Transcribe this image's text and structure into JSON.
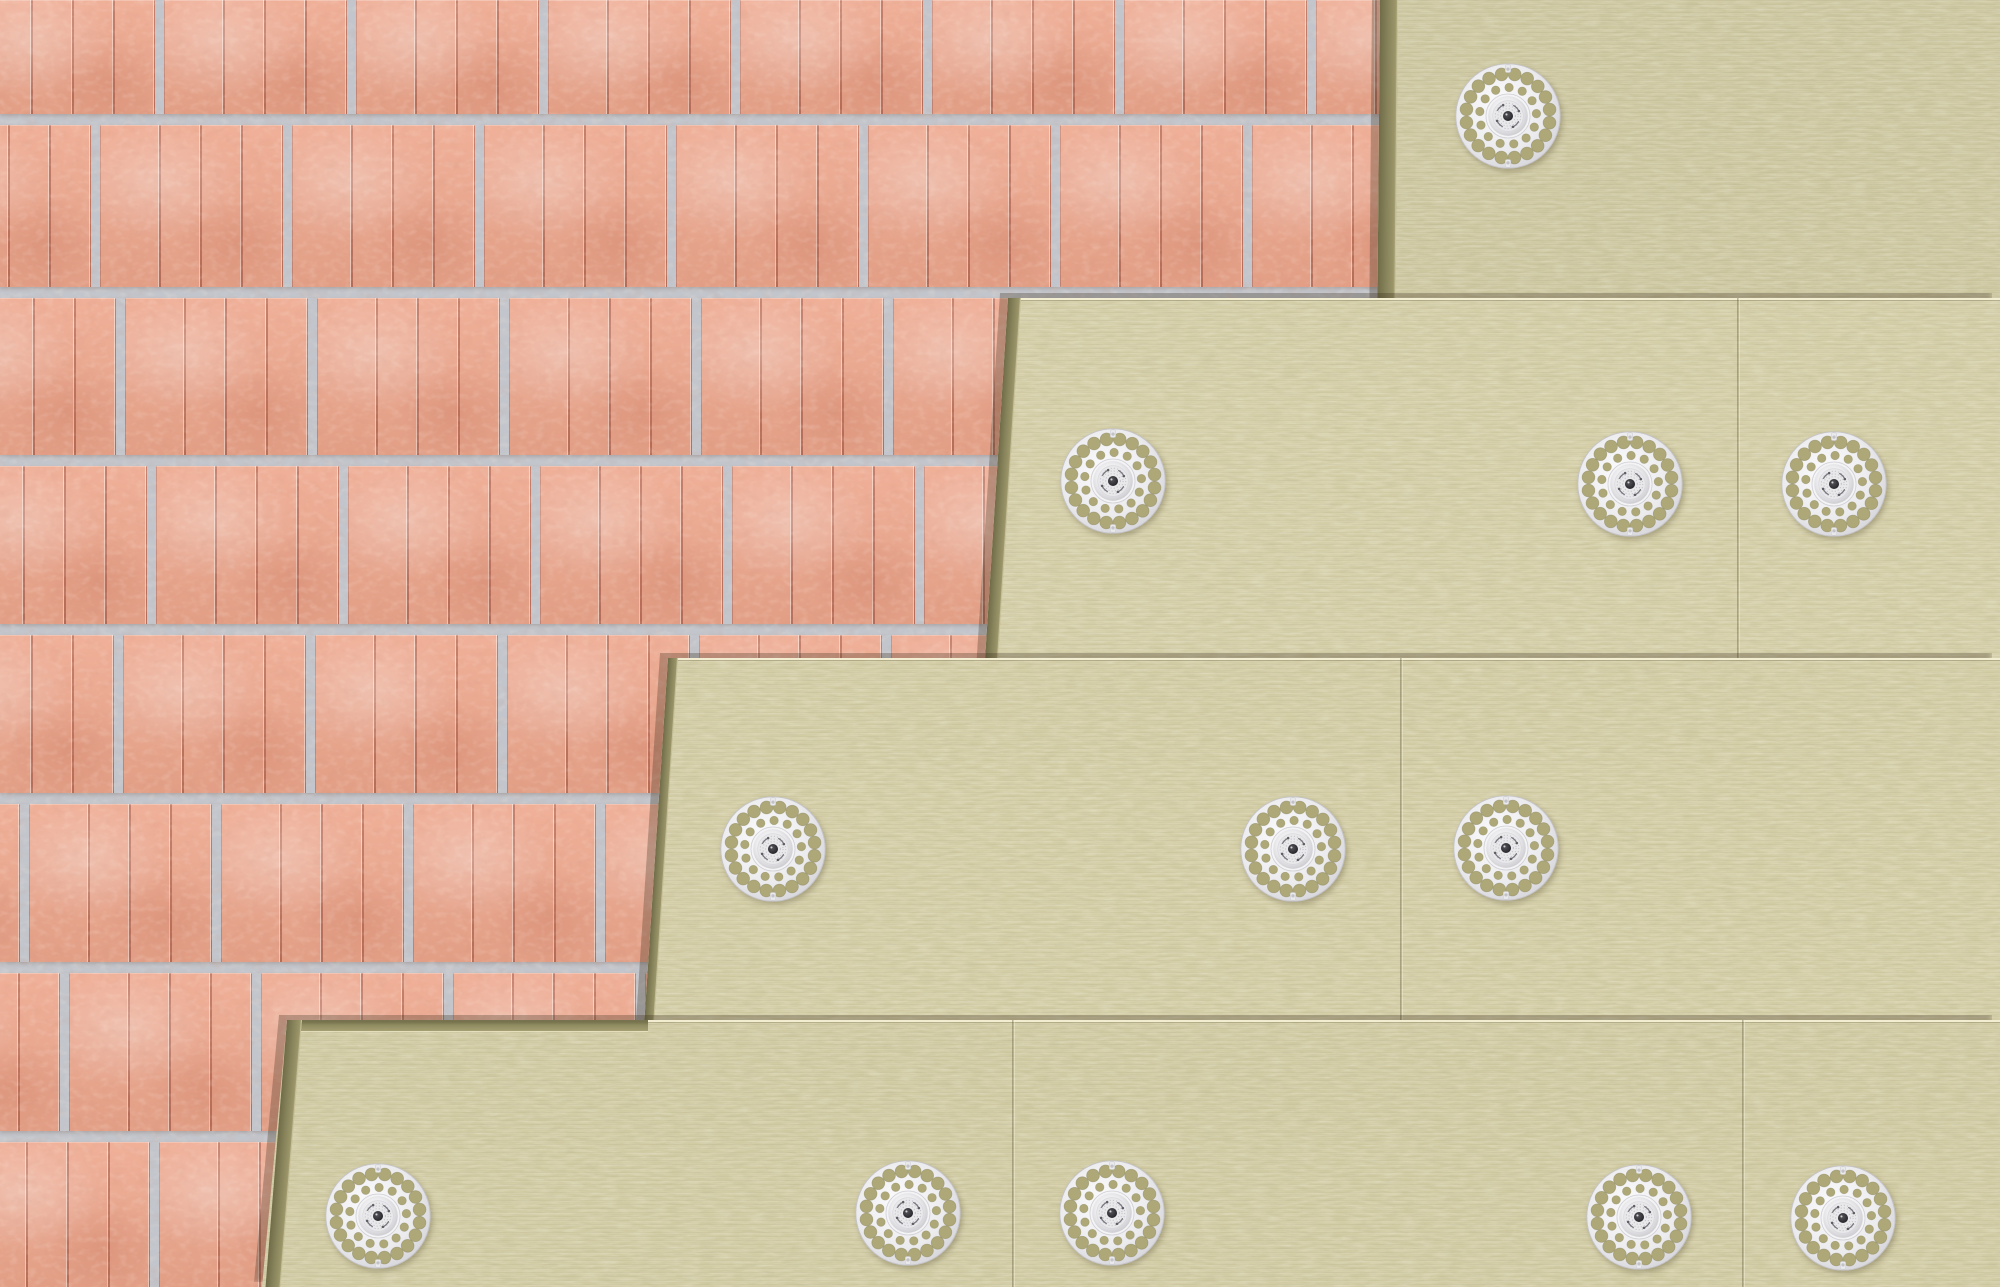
{
  "scene": {
    "description": "3D cutaway illustration of four staggered layers of mineral wool insulation boards fixed to a perforated clay block masonry wall with round perforated plastic insulation anchors",
    "canvas": {
      "width": 2000,
      "height": 1287
    },
    "layer_count": 4,
    "anchor_count": 12
  },
  "colors": {
    "mortar": "#c2c5cb",
    "brick_face": "#eea78d",
    "brick_groove": "#964734",
    "insulation_face_layer1": "#cdc7a0",
    "insulation_face_layer2": "#d4cea7",
    "insulation_face_layer3": "#d3cda5",
    "insulation_face_layer4": "#d1cba3",
    "insulation_cut_edge": "#8f8b60",
    "anchor_plastic": "#f0f0f3",
    "anchor_hole": "#aea878",
    "anchor_screw": "#2e2e31"
  },
  "brick": {
    "mortar_ys": [
      114,
      287,
      455,
      624,
      793,
      962,
      1131
    ],
    "mortar_h": 11,
    "block_pitch": 192,
    "block_w": 183,
    "joint_w": 9,
    "row_offsets": [
      155,
      91,
      116,
      147,
      114,
      20,
      60,
      150
    ]
  },
  "layers": [
    {
      "id": "insulation-layer-1",
      "face": "#cdc7a0",
      "clip": "polygon(1380px 0px, 2000px 0px, 2000px 1287px, 1369px 1287px)",
      "edge_left": {
        "x": 1380,
        "y": 0,
        "w": 18,
        "h": 1287,
        "skew": -0.49
      },
      "edge_top": null,
      "top_line": null,
      "seams": []
    },
    {
      "id": "insulation-layer-2",
      "face": "#d4cea7",
      "clip": "polygon(1008px 298px, 2000px 298px, 2000px 1287px, 945px 1287px)",
      "edge_left": {
        "x": 1008,
        "y": 298,
        "w": 13,
        "h": 989,
        "skew": -3.65
      },
      "edge_top": null,
      "top_line": {
        "x": 1008,
        "y": 298,
        "w": 992
      },
      "seams": [
        {
          "x": 1737,
          "y": 298,
          "h": 989
        }
      ]
    },
    {
      "id": "insulation-layer-3",
      "face": "#d3cda5",
      "clip": "polygon(668px 658px, 2000px 658px, 2000px 1287px, 627px 1287px)",
      "edge_left": {
        "x": 668,
        "y": 658,
        "w": 10,
        "h": 629,
        "skew": -3.73
      },
      "edge_top": null,
      "top_line": {
        "x": 668,
        "y": 658,
        "w": 1332
      },
      "seams": [
        {
          "x": 1400,
          "y": 658,
          "h": 629
        }
      ]
    },
    {
      "id": "insulation-layer-4",
      "face": "#d1cba3",
      "clip": "polygon(287px 1020px, 2000px 1020px, 2000px 1287px, 262px 1287px)",
      "edge_left": {
        "x": 287,
        "y": 1020,
        "w": 15,
        "h": 267,
        "skew": -4.6
      },
      "edge_top": {
        "x": 287,
        "y": 1020,
        "w": 361,
        "h": 11
      },
      "top_line": {
        "x": 648,
        "y": 1020,
        "w": 1352
      },
      "seams": [
        {
          "x": 1012,
          "y": 1020,
          "h": 267
        },
        {
          "x": 1742,
          "y": 1020,
          "h": 267
        }
      ]
    }
  ],
  "anchors": [
    {
      "x": 1508,
      "y": 116
    },
    {
      "x": 1113,
      "y": 481
    },
    {
      "x": 1630,
      "y": 484
    },
    {
      "x": 1834,
      "y": 484
    },
    {
      "x": 773,
      "y": 849
    },
    {
      "x": 1293,
      "y": 849
    },
    {
      "x": 1506,
      "y": 848
    },
    {
      "x": 378,
      "y": 1216
    },
    {
      "x": 908,
      "y": 1213
    },
    {
      "x": 1112,
      "y": 1213
    },
    {
      "x": 1639,
      "y": 1217
    },
    {
      "x": 1843,
      "y": 1218
    }
  ],
  "anchor_design": {
    "diameter": 110,
    "outer_holes": 20,
    "outer_ring_radius": 43.5,
    "outer_hole_r": 6.6,
    "inner_holes": 13,
    "inner_ring_radius": 29.5,
    "inner_hole_r": 4.4,
    "dome_radius": 20.5,
    "screw_radius": 5.2
  }
}
